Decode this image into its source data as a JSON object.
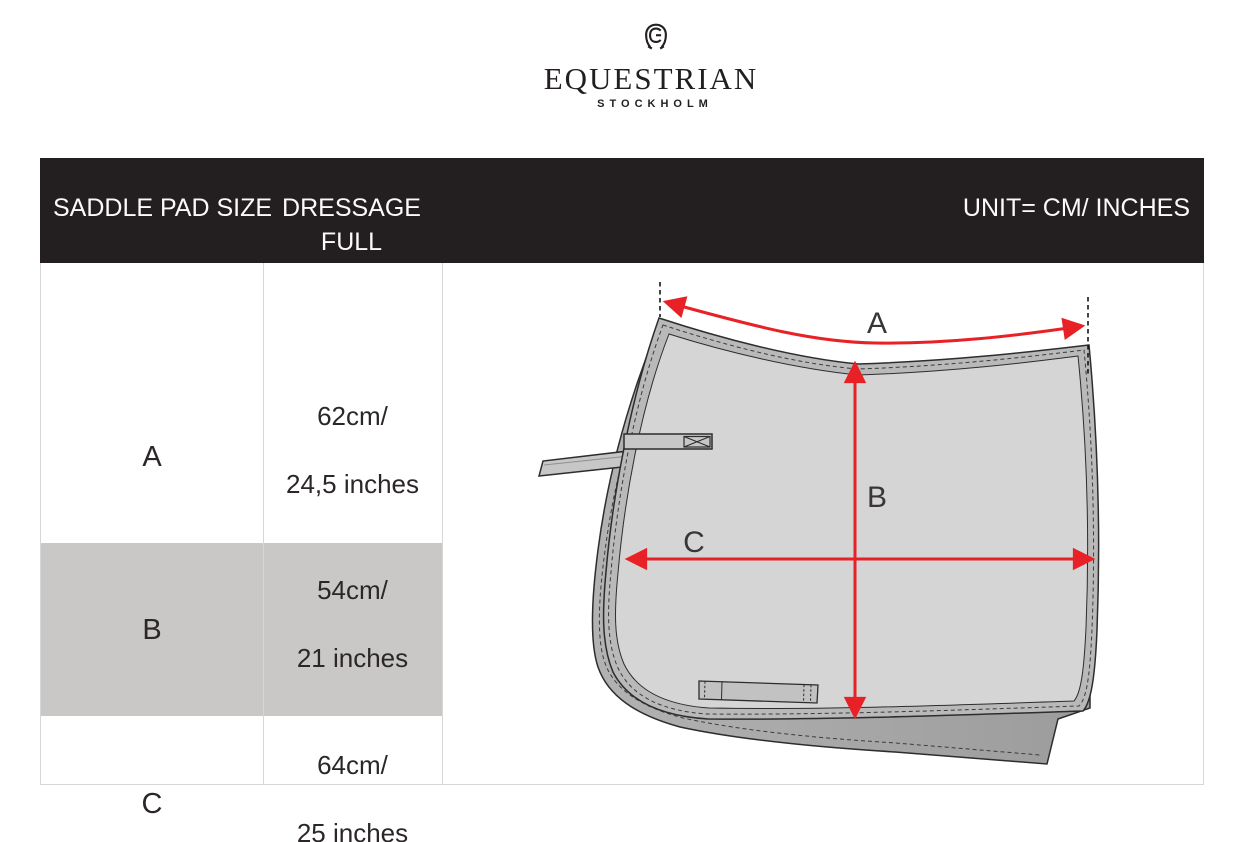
{
  "brand": {
    "icon": "horseshoe-e-monogram-icon",
    "name": "EQUESTRIAN",
    "city": "STOCKHOLM"
  },
  "header": {
    "size_column": "SADDLE PAD SIZE",
    "model_column_line1": "DRESSAGE",
    "model_column_line2": "FULL",
    "unit_note": "UNIT= CM/ INCHES"
  },
  "table": {
    "rows": [
      {
        "label": "A",
        "cm": "62cm/",
        "inches": "24,5 inches"
      },
      {
        "label": "B",
        "cm": "54cm/",
        "inches": "21 inches"
      },
      {
        "label": "C",
        "cm": "64cm/",
        "inches": "25 inches"
      }
    ],
    "highlighted_row": "B"
  },
  "diagram": {
    "label_a": "A",
    "label_b": "B",
    "label_c": "C"
  },
  "chart_data": {
    "type": "table",
    "title": "Saddle pad size - Dressage Full",
    "unit": "cm / inches",
    "columns": [
      "SADDLE PAD SIZE",
      "DRESSAGE FULL"
    ],
    "rows": [
      [
        "A",
        "62 cm / 24.5 inches"
      ],
      [
        "B",
        "54 cm / 21 inches"
      ],
      [
        "C",
        "64 cm / 25 inches"
      ]
    ]
  },
  "colors": {
    "header_bg": "#231f20",
    "row_highlight": "#cac8c6",
    "arrow_red": "#e82127",
    "pad_fill": "#d5d5d5",
    "pad_trim": "#b9b9b9",
    "pad_underlayer": "#a6a6a6",
    "border": "#d6d6d6",
    "text": "#2b2728"
  }
}
